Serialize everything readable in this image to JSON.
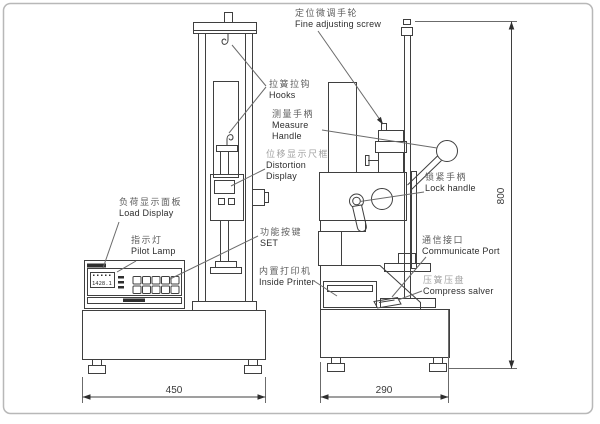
{
  "diagram": {
    "labels": {
      "fine_adjusting_screw": {
        "cn": "定位微调手轮",
        "en": "Fine adjusting screw"
      },
      "hooks": {
        "cn": "拉簧拉钩",
        "en": "Hooks"
      },
      "measure_handle": {
        "cn": "测量手柄",
        "en": "Measure Handle"
      },
      "distortion_display": {
        "cn": "位移显示尺框",
        "en": "Distortion Display"
      },
      "load_display": {
        "cn": "负荷显示面板",
        "en": "Load Display"
      },
      "pilot_lamp": {
        "cn": "指示灯",
        "en": "Pilot Lamp"
      },
      "set_keys": {
        "cn": "功能按键",
        "en": "SET"
      },
      "inside_printer": {
        "cn": "内置打印机",
        "en": "Inside Printer"
      },
      "lock_handle": {
        "cn": "锁紧手柄",
        "en": "Lock handle"
      },
      "communicate_port": {
        "cn": "通信接口",
        "en": "Communicate Port"
      },
      "compress_salver": {
        "cn": "压簧压盘",
        "en": "Compress salver"
      }
    },
    "dimensions": {
      "front_width": "450",
      "side_width": "290",
      "height": "800"
    },
    "panel": {
      "display_value": "1428.1"
    },
    "colors": {
      "line": "#3f3f3f",
      "label_en": "#2e2e2e",
      "label_cn": "#5f5f5f",
      "label_cn_light": "#a2a2a2",
      "frame": "#b8b8b8"
    }
  }
}
